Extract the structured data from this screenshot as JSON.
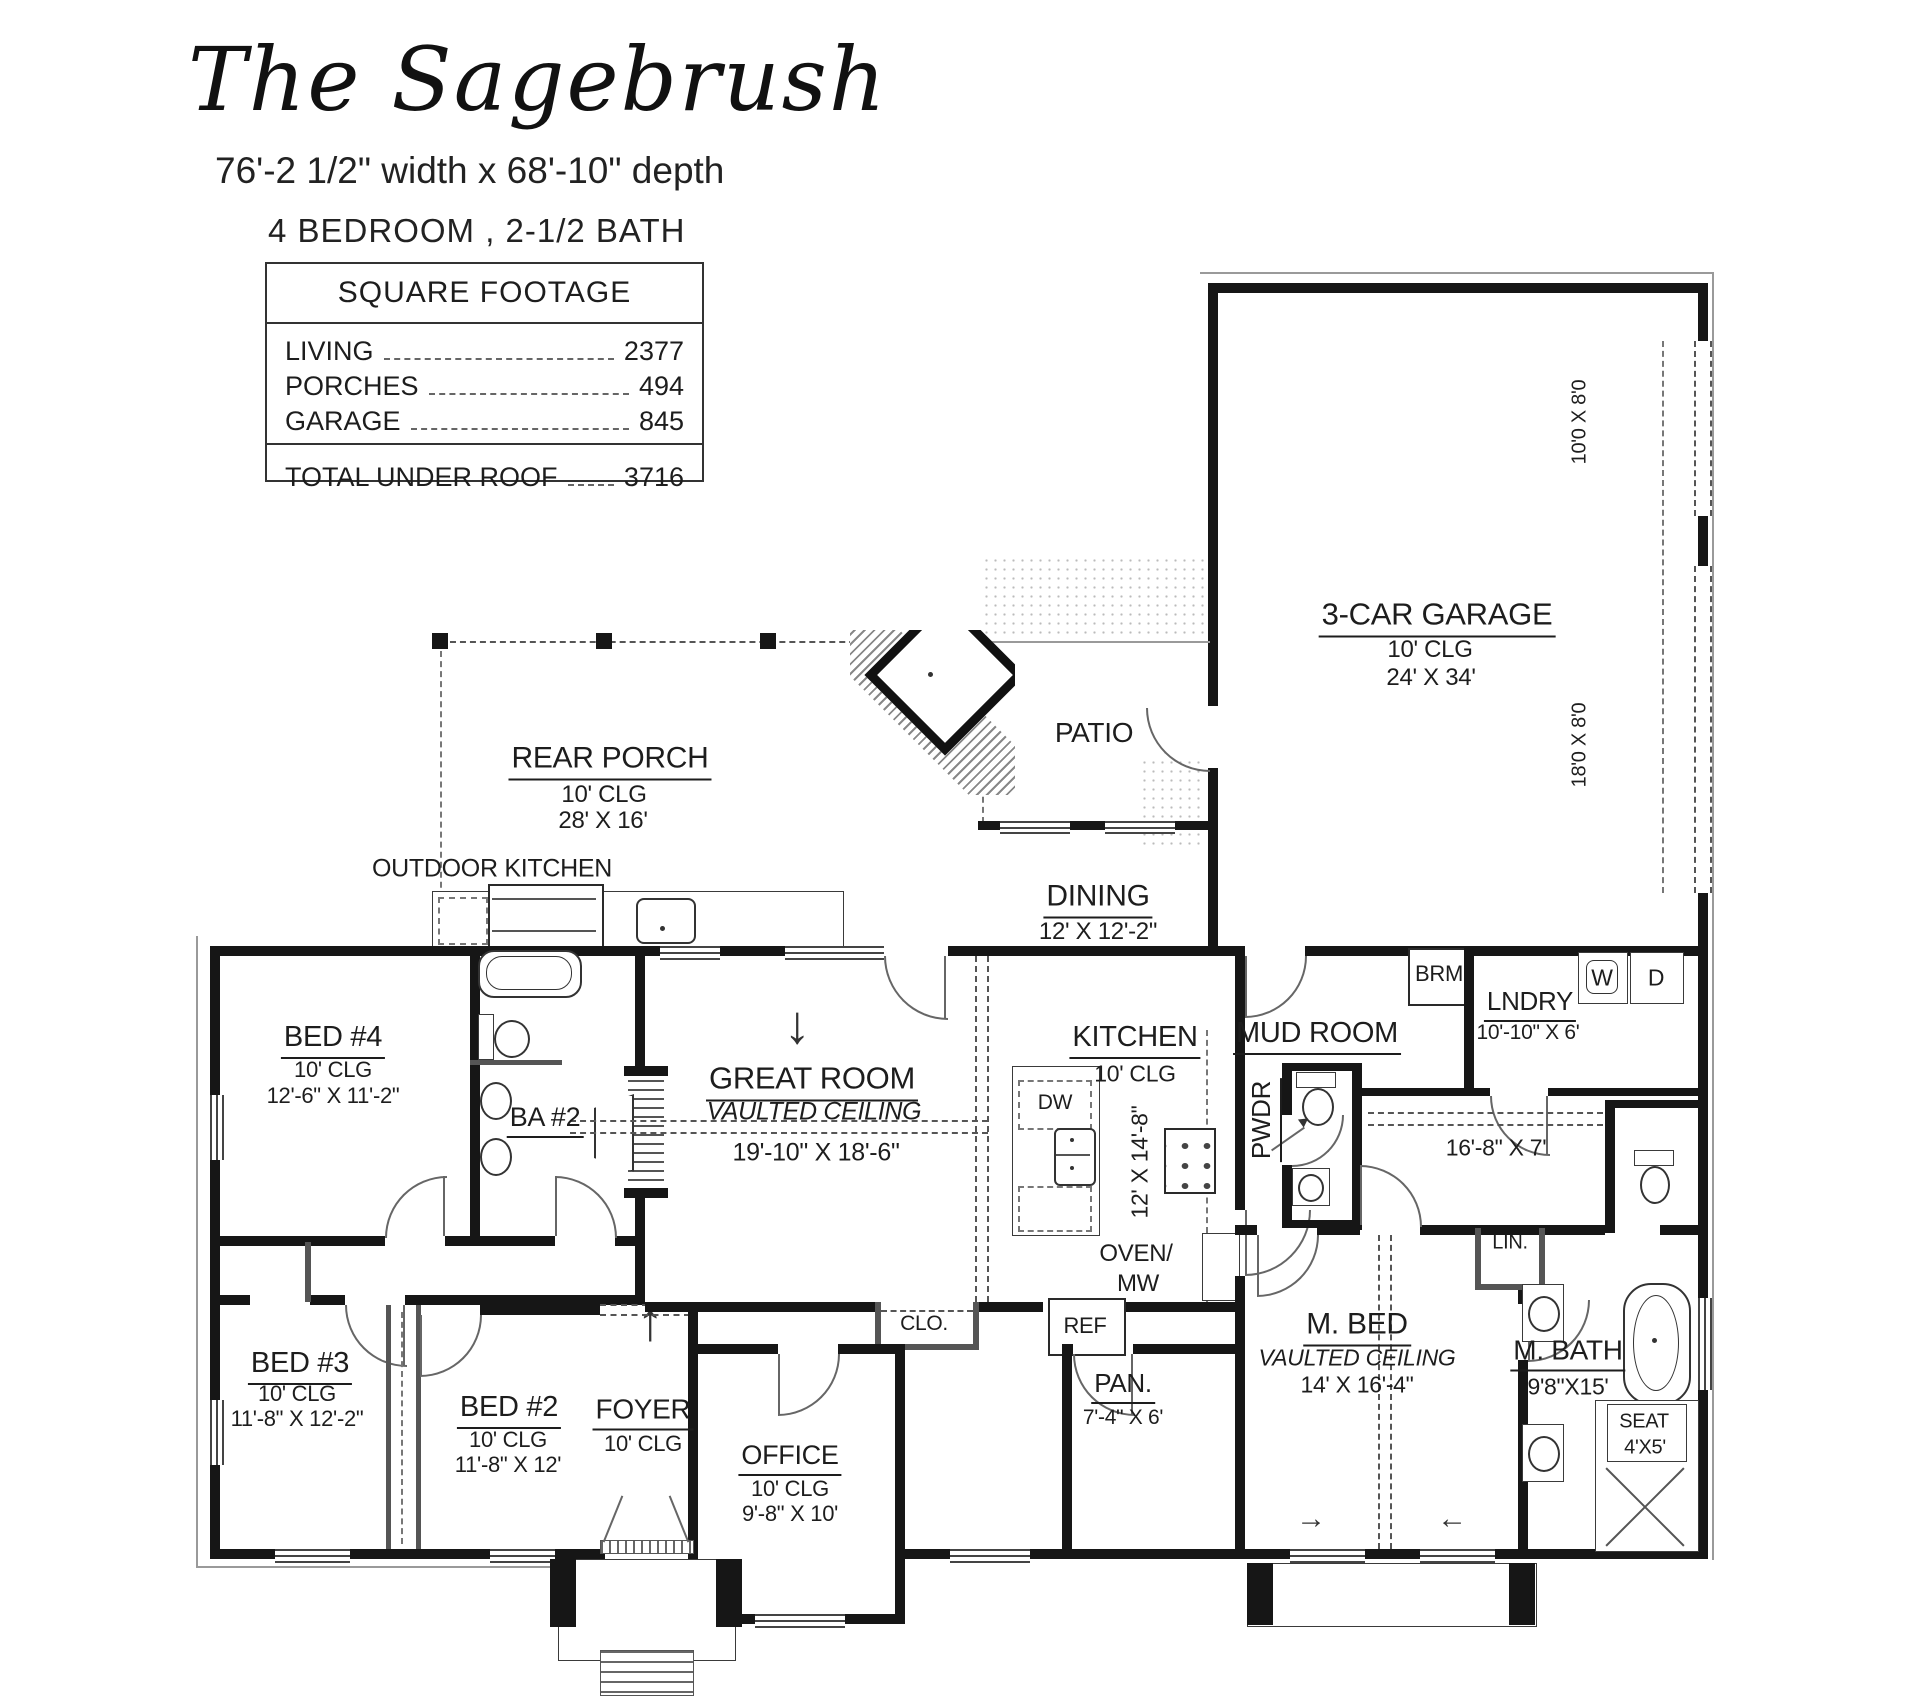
{
  "header": {
    "title": "The Sagebrush",
    "size": "76'-2 1/2\" width x 68'-10\" depth",
    "bed_bath": "4 BEDROOM , 2-1/2 BATH"
  },
  "square_footage": {
    "title": "SQUARE FOOTAGE",
    "rows": [
      {
        "label": "LIVING",
        "value": "2377"
      },
      {
        "label": "PORCHES",
        "value": "494"
      },
      {
        "label": "GARAGE",
        "value": "845"
      }
    ],
    "total": {
      "label": "TOTAL UNDER ROOF",
      "value": "3716"
    }
  },
  "rooms": {
    "garage": {
      "name": "3-CAR GARAGE",
      "clg": "10' CLG",
      "dims": "24' X 34'",
      "door_small": "10'0 X 8'0",
      "door_large": "18'0 X 8'0"
    },
    "rear_porch": {
      "name": "REAR PORCH",
      "clg": "10' CLG",
      "dims": "28' X 16'"
    },
    "outdoor_kitchen": {
      "name": "OUTDOOR KITCHEN"
    },
    "patio": {
      "name": "PATIO"
    },
    "dining": {
      "name": "DINING",
      "dims": "12' X 12'-2\""
    },
    "great_room": {
      "name": "GREAT ROOM",
      "ceiling": "VAULTED CEILING",
      "dims": "19'-10\" X 18'-6\""
    },
    "kitchen": {
      "name": "KITCHEN",
      "clg": "10' CLG",
      "dims": "12' X 14'-8\"",
      "dw": "DW",
      "oven": "OVEN/",
      "mw": "MW",
      "ref": "REF"
    },
    "mud_room": {
      "name": "MUD ROOM"
    },
    "pwdr": {
      "name": "PWDR"
    },
    "brm": {
      "name": "BRM"
    },
    "laundry": {
      "name": "LNDRY",
      "dims": "10'-10\" X 6'",
      "washer": "W",
      "dryer": "D"
    },
    "master_bed": {
      "name": "M. BED",
      "ceiling": "VAULTED CEILING",
      "dims": "14' X 16'-4\""
    },
    "master_closet": {
      "dims": "16'-8\" X 7'"
    },
    "linen": {
      "name": "LIN."
    },
    "master_bath": {
      "name": "M. BATH",
      "dims": "9'8\"X15'",
      "seat": "SEAT",
      "shower_dims": "4'X5'"
    },
    "bed4": {
      "name": "BED #4",
      "clg": "10' CLG",
      "dims": "12'-6\" X 11'-2\""
    },
    "bath2": {
      "name": "BA #2"
    },
    "bed3": {
      "name": "BED #3",
      "clg": "10' CLG",
      "dims": "11'-8\" X 12'-2\""
    },
    "bed2": {
      "name": "BED #2",
      "clg": "10' CLG",
      "dims": "11'-8\" X 12'"
    },
    "foyer": {
      "name": "FOYER",
      "clg": "10' CLG"
    },
    "office": {
      "name": "OFFICE",
      "clg": "10' CLG",
      "dims": "9'-8\" X 10'"
    },
    "pantry": {
      "name": "PAN.",
      "dims": "7'-4\" X 6'"
    },
    "closet": {
      "name": "CLO."
    }
  },
  "arrows": {
    "down": "↓",
    "up": "↑",
    "left": "←",
    "right": "→"
  },
  "colors": {
    "wall": "#161616",
    "line": "#555",
    "paper": "#ffffff"
  }
}
